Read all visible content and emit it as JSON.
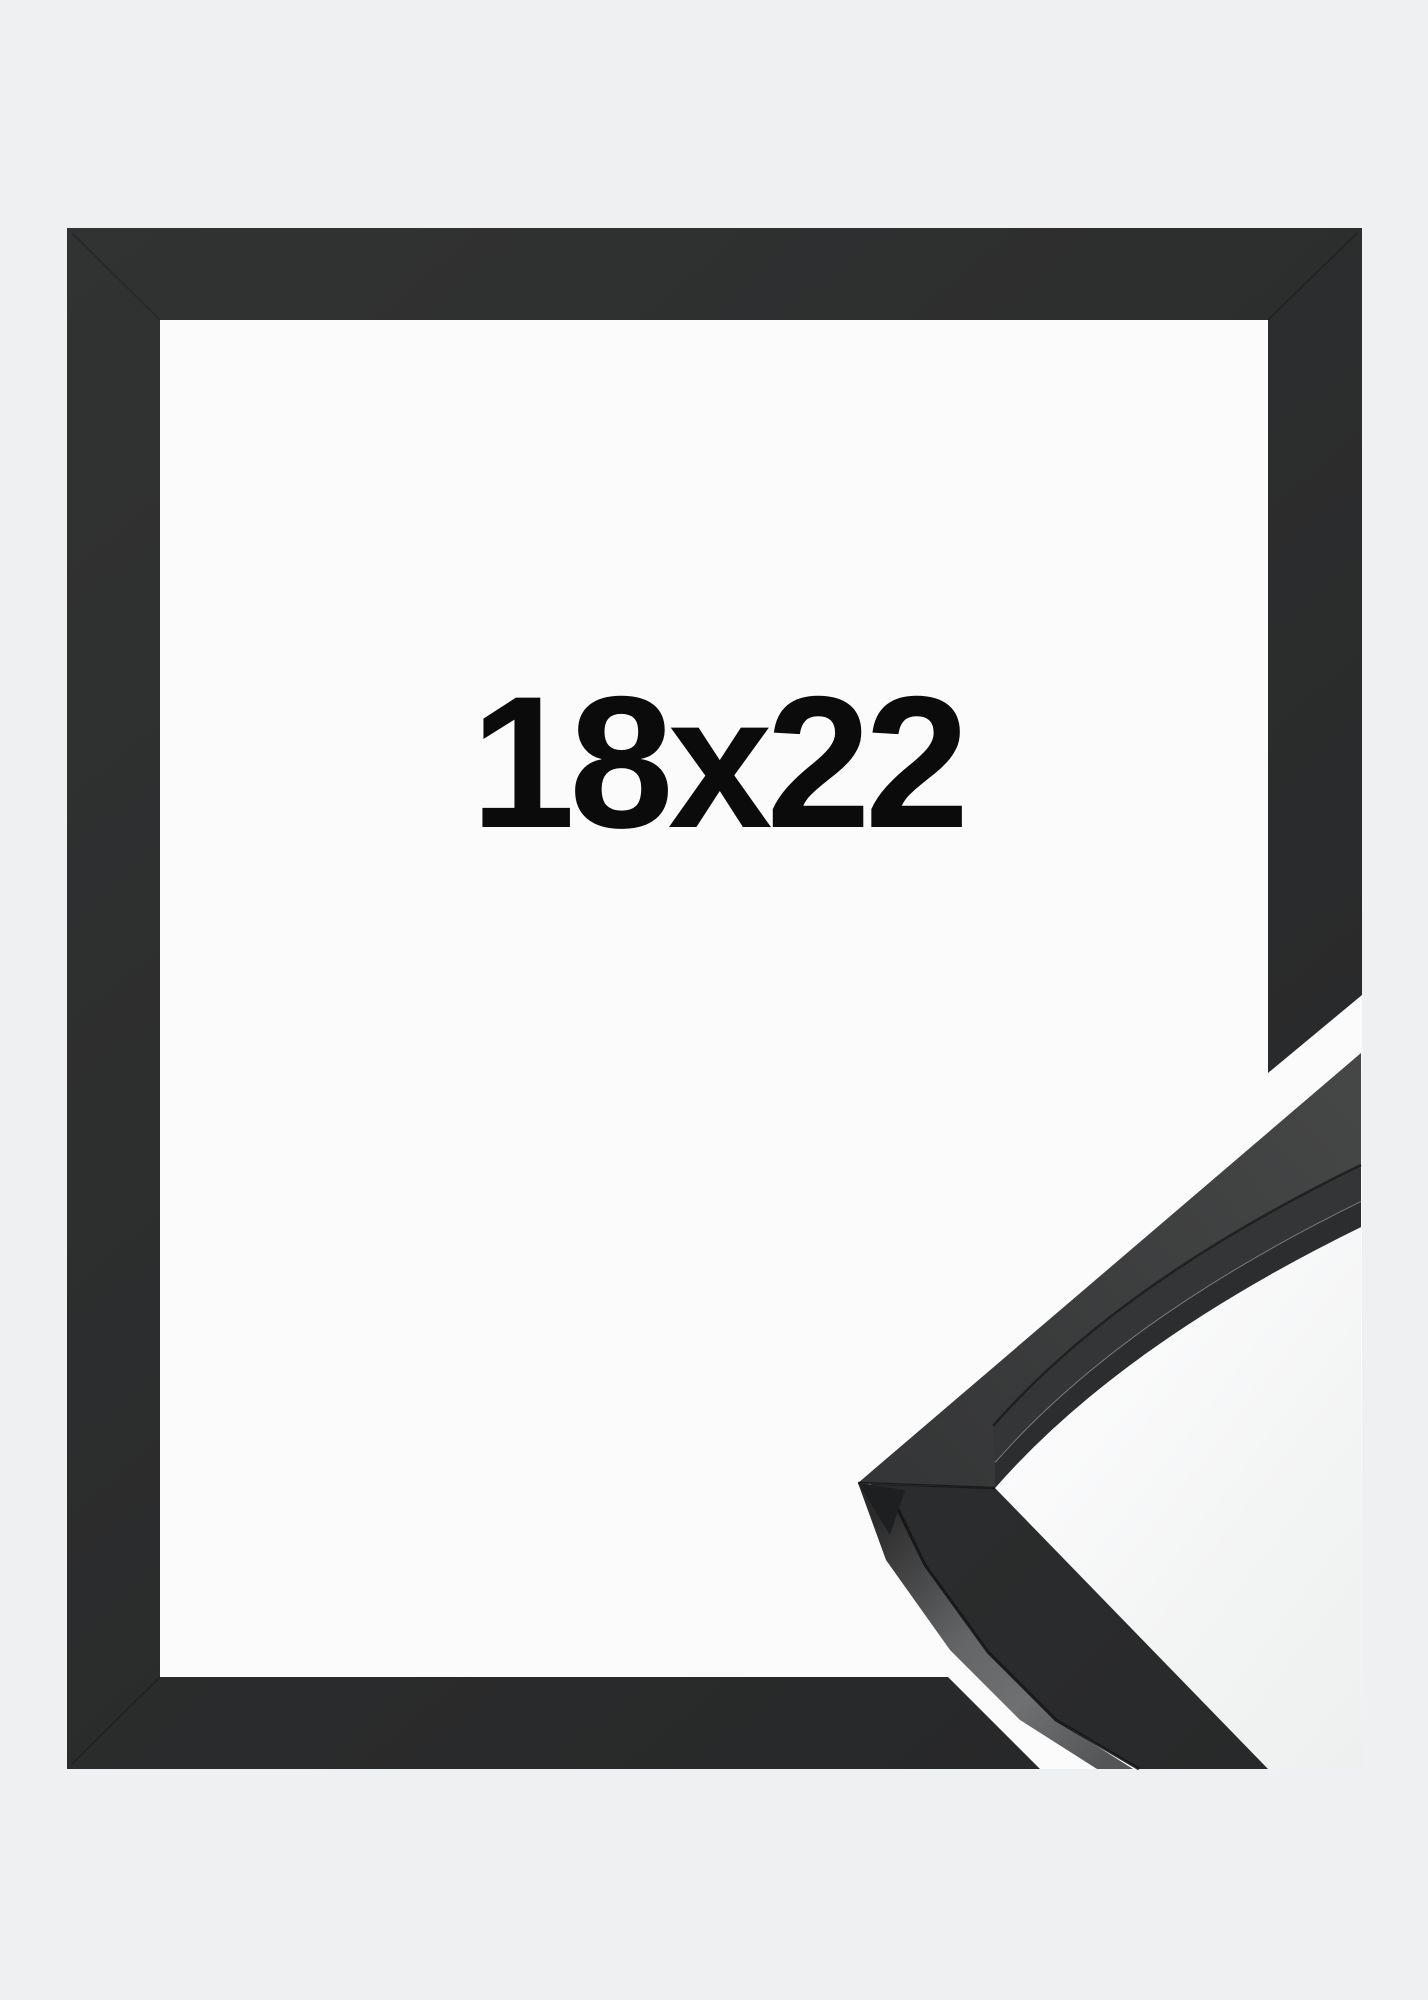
{
  "product_photo": {
    "size_label": "18x22",
    "colors": {
      "page_bg": "#eff0f1",
      "mat_white": "#fbfbfc",
      "frame_dark": "#313232",
      "frame_dark_deep": "#262728",
      "label_text": "#0b0b0c",
      "profile_face": "#343536",
      "profile_face_light": "#464747",
      "profile_lower_face": "#28292a",
      "profile_side_highlight": "#6f7071"
    }
  }
}
